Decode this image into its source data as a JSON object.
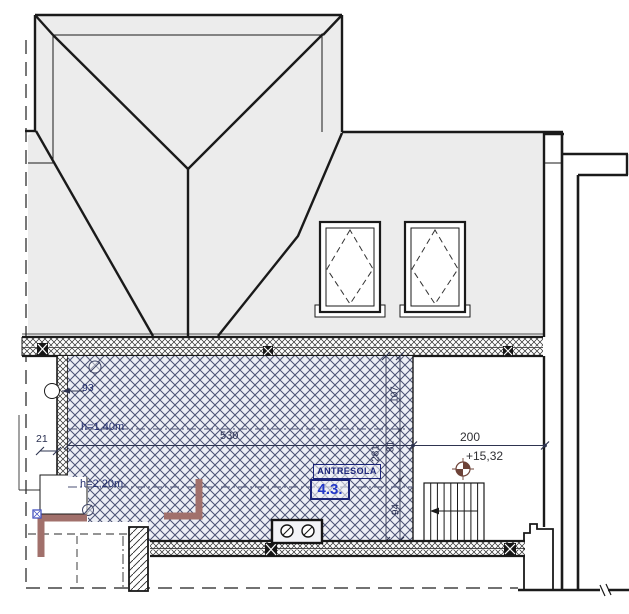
{
  "drawing": {
    "room": {
      "name": "ANTRESOLA",
      "number": "4.3."
    },
    "level_mark": "+15,32",
    "heights": {
      "upper": "h=1,40m",
      "lower": "h=2,20m"
    },
    "dimensions": {
      "mezzanine_width": "530",
      "right_span": "200",
      "left_offset": "21",
      "beam_width": "93",
      "seg_top": "107",
      "seg_mid": "81",
      "seg_bottom": "94",
      "total_height": "281"
    },
    "colors": {
      "line": "#1a1a1a",
      "roof_fill": "#ececec",
      "hatch_bg": "#edeff5",
      "hatch_stroke": "#4b5274",
      "label_navy": "#1b2478",
      "room_number_blue": "#2338c8",
      "steel_brown": "#a1706b",
      "level_brown": "#6e4338"
    }
  }
}
